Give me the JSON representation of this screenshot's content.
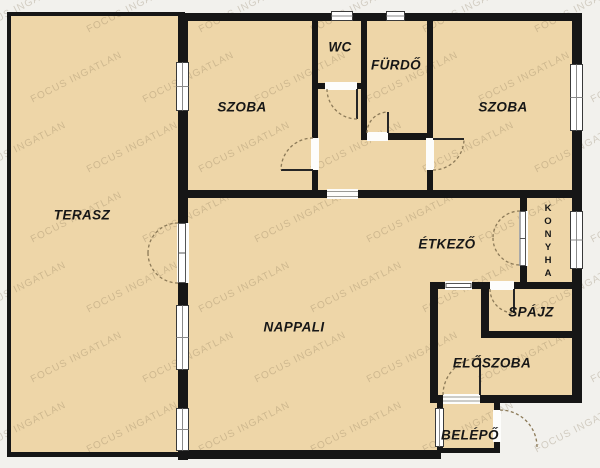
{
  "plan": {
    "watermark_text": "FOCUS INGATLAN",
    "colors": {
      "floor": "#eed6a8",
      "wall": "#161616",
      "background": "#f2f1ed",
      "door_arc": "#8c7a58",
      "watermark": "rgba(125,108,78,0.28)"
    },
    "rooms": {
      "terasz": {
        "label": "TERASZ"
      },
      "szoba_left": {
        "label": "SZOBA"
      },
      "wc": {
        "label": "WC"
      },
      "furdo": {
        "label": "FÜRDŐ"
      },
      "szoba_right": {
        "label": "SZOBA"
      },
      "etkezo": {
        "label": "ÉTKEZŐ"
      },
      "konyha": {
        "label": "KONYHA"
      },
      "spajz": {
        "label": "SPÁJZ"
      },
      "nappali": {
        "label": "NAPPALI"
      },
      "eloszoba": {
        "label": "ELŐSZOBA"
      },
      "belepo": {
        "label": "BELÉPŐ"
      }
    }
  }
}
